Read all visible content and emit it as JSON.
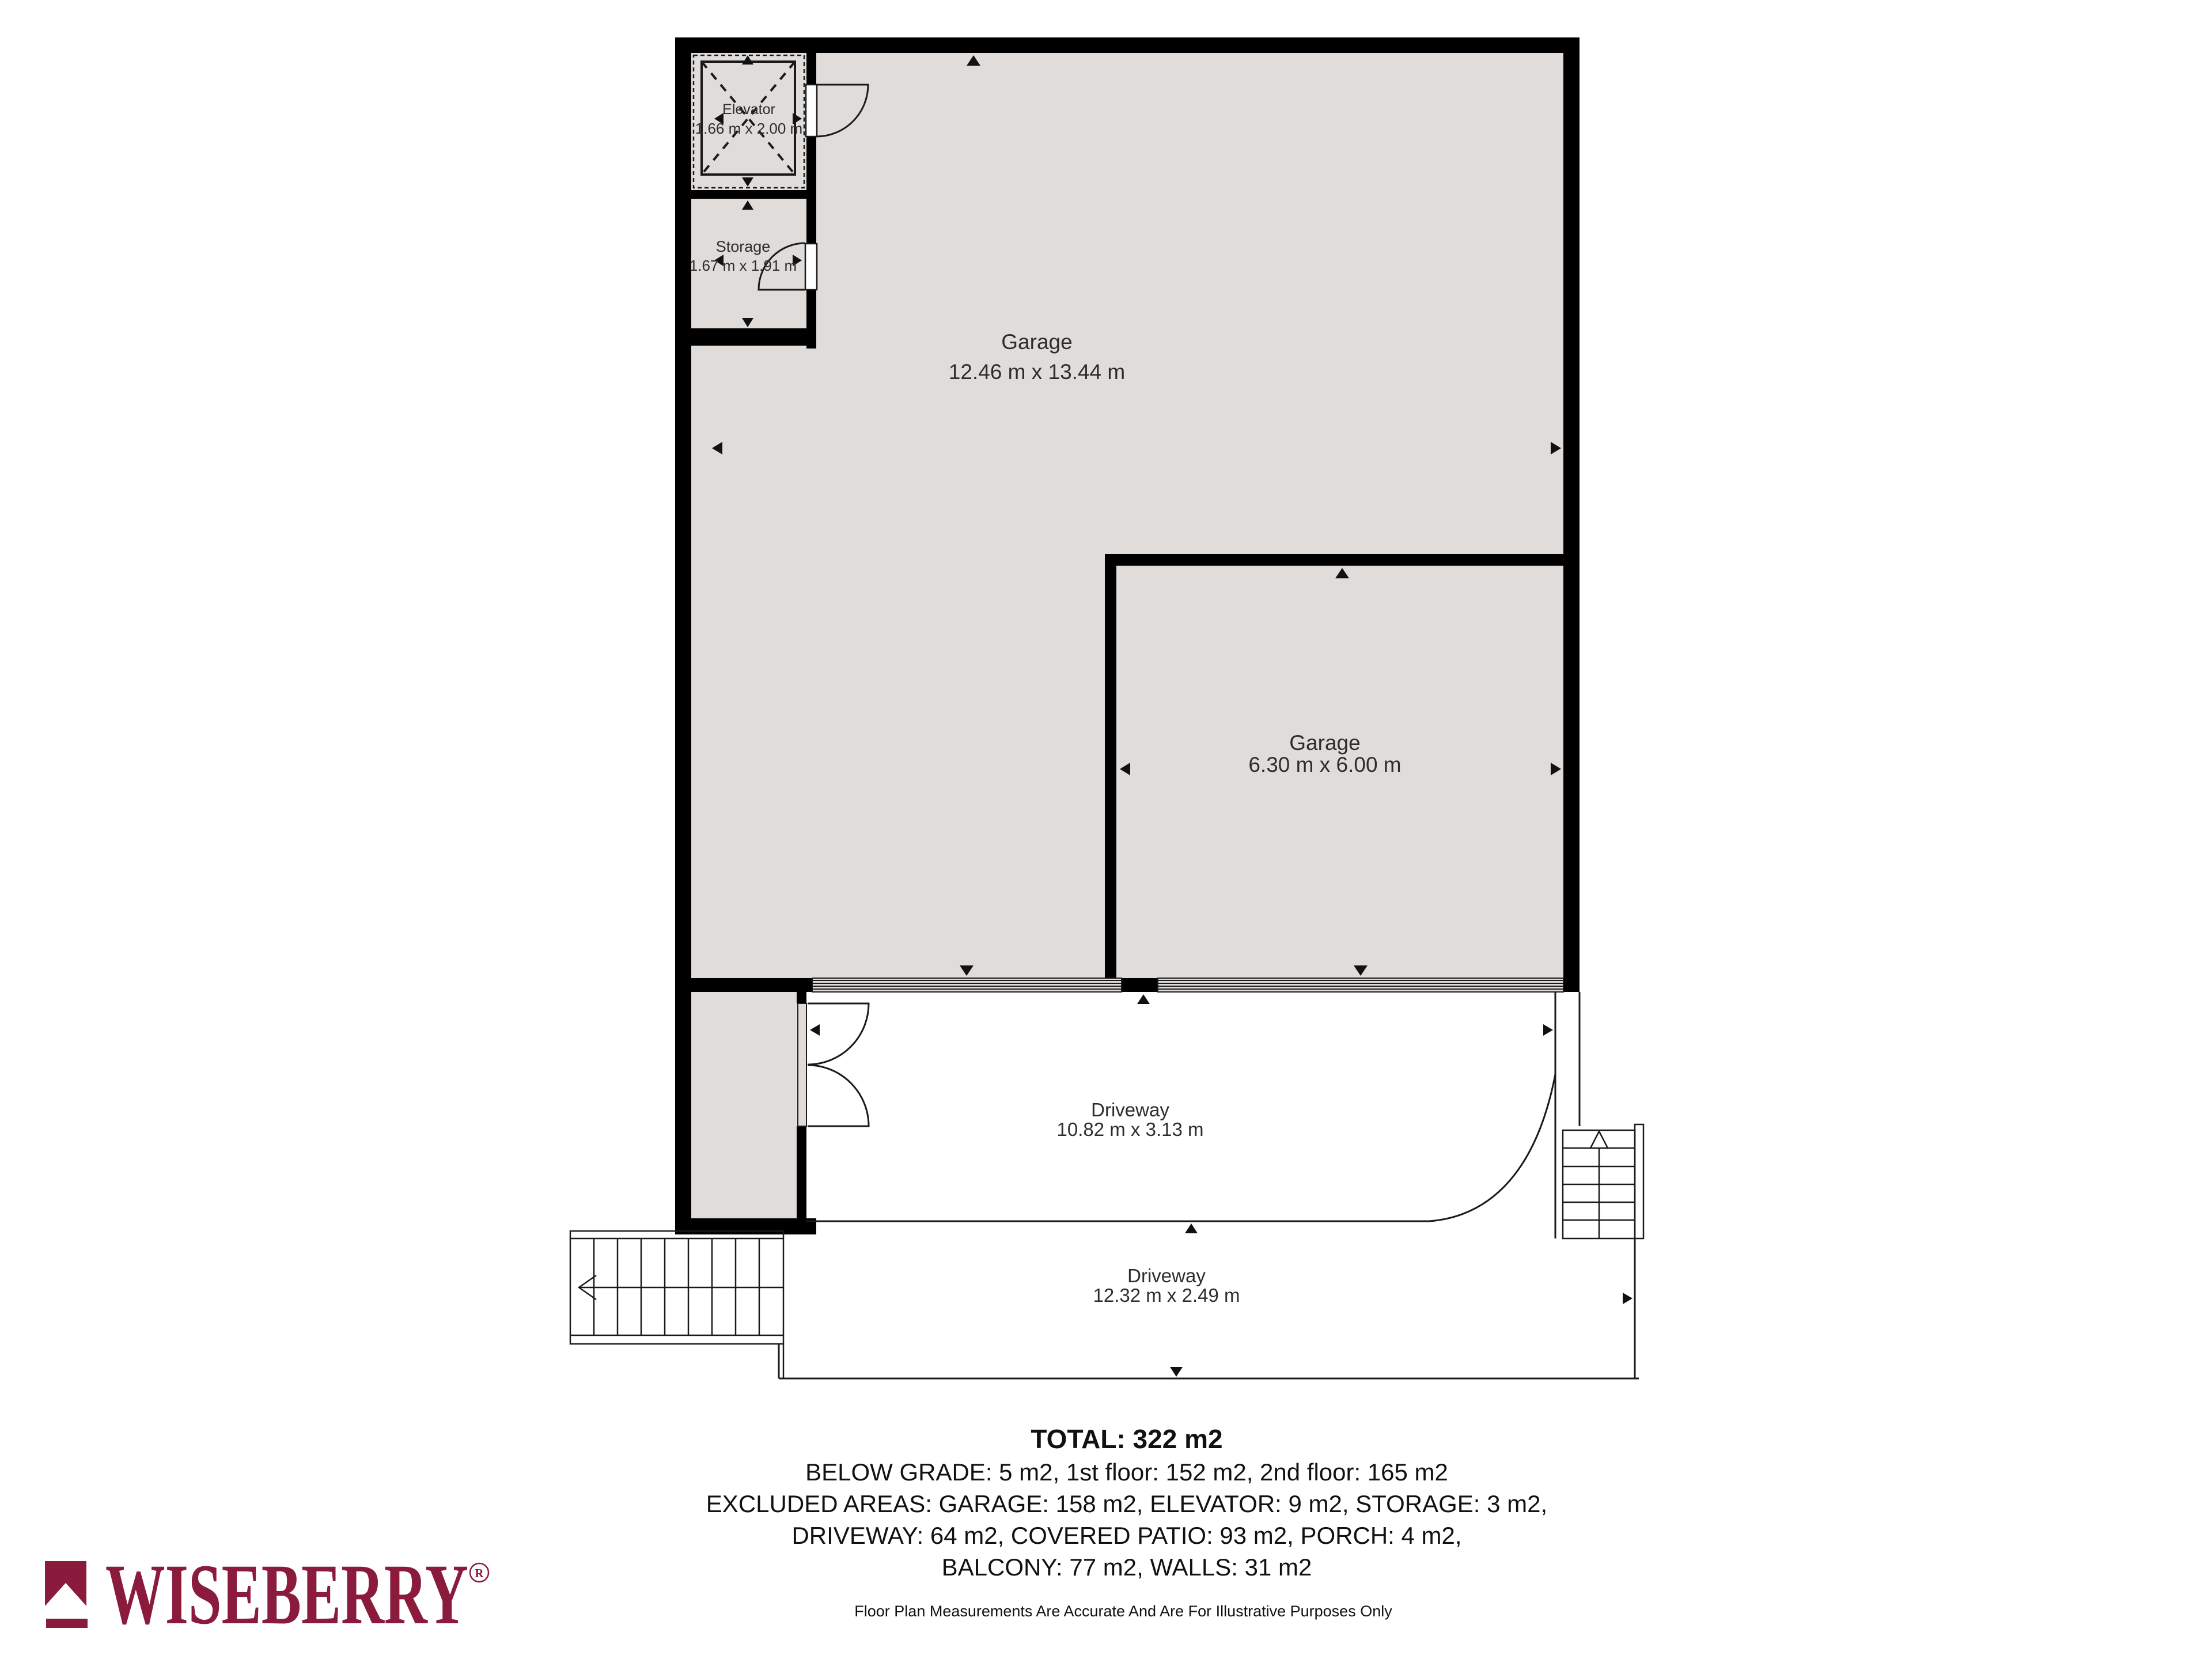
{
  "plan": {
    "rooms": [
      {
        "label": "Elevator",
        "dims": "1.66 m x 2.00 m"
      },
      {
        "label": "Storage",
        "dims": "1.67 m x 1.91 m"
      },
      {
        "label": "Garage",
        "dims": "12.46 m x 13.44 m"
      },
      {
        "label": "Garage",
        "dims": "6.30 m x 6.00 m"
      },
      {
        "label": "Driveway",
        "dims": "10.82 m x 3.13 m"
      },
      {
        "label": "Driveway",
        "dims": "12.32 m x 2.49 m"
      }
    ]
  },
  "summary": {
    "total": "TOTAL: 322 m2",
    "line1": "BELOW GRADE: 5 m2, 1st floor: 152 m2, 2nd floor: 165 m2",
    "line2": "EXCLUDED AREAS: GARAGE: 158 m2, ELEVATOR: 9 m2, STORAGE: 3 m2,",
    "line3": "DRIVEWAY: 64 m2, COVERED PATIO: 93 m2, PORCH: 4 m2,",
    "line4": "BALCONY: 77 m2, WALLS: 31 m2",
    "disclaimer": "Floor Plan Measurements Are Accurate And Are For Illustrative Purposes Only"
  },
  "branding": {
    "name": "WISEBERRY",
    "registered": "R",
    "color": "#8a1b3d"
  },
  "colors": {
    "room_fill": "#dfdcda",
    "wall": "#000000",
    "line": "#1a1a1a",
    "background": "#ffffff"
  }
}
